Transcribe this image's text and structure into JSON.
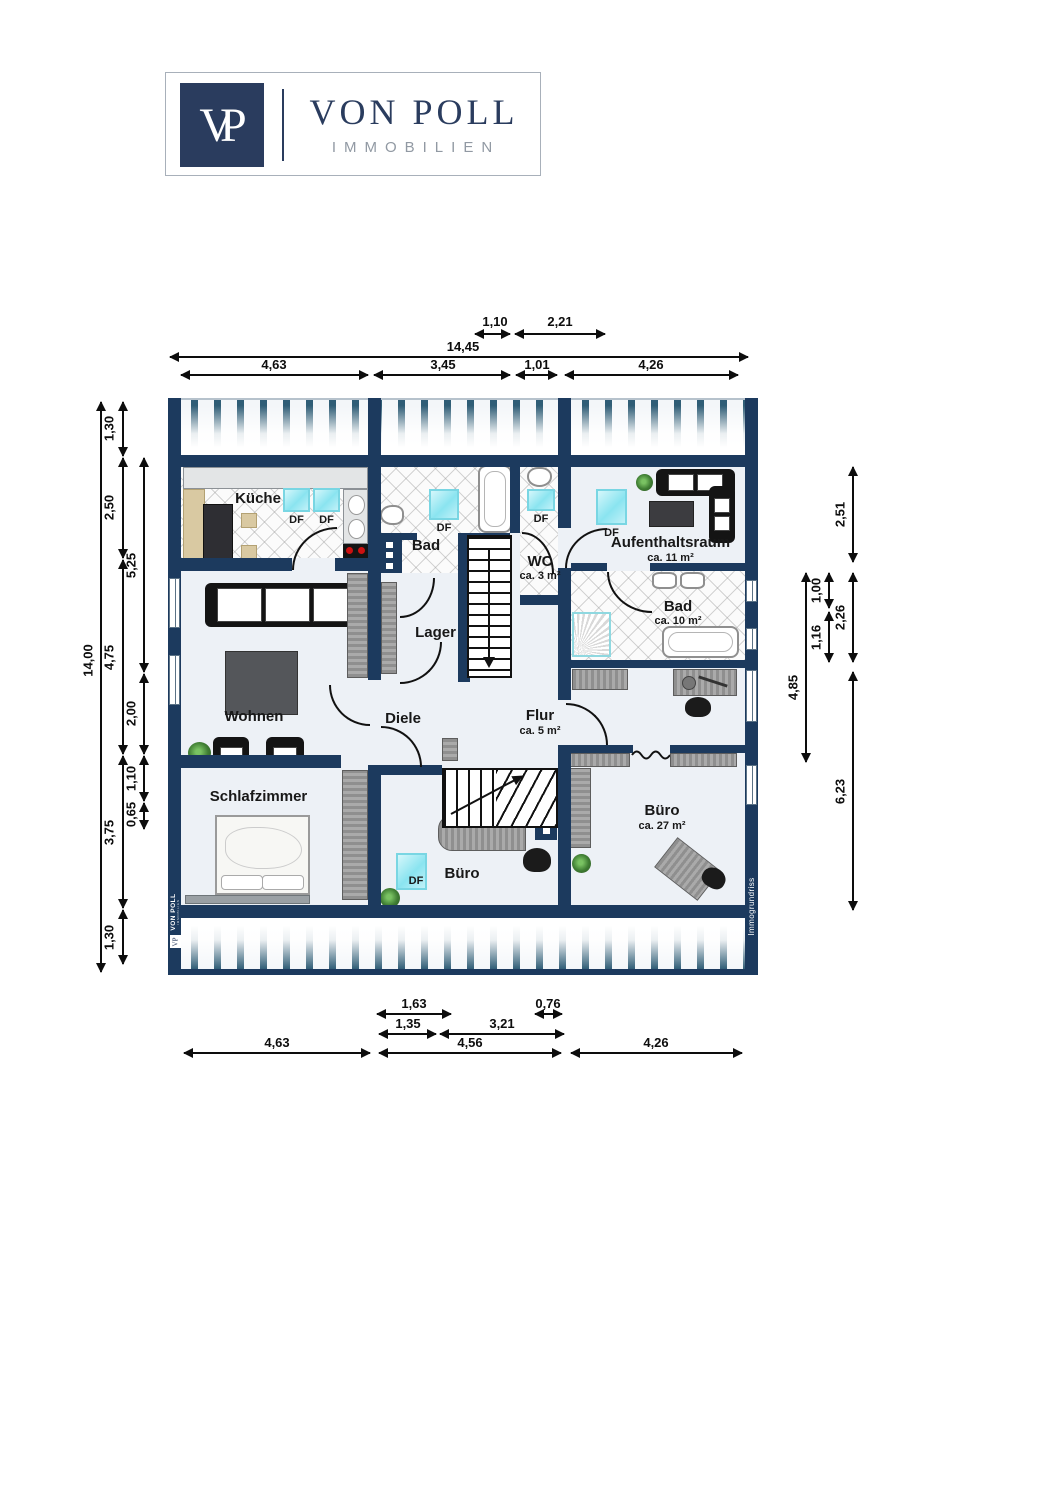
{
  "logo": {
    "monogram": "VP",
    "name": "VON POLL",
    "subtitle": "IMMOBILIEN"
  },
  "labels": {
    "df": "DF"
  },
  "rooms": {
    "kueche": {
      "label": "Küche"
    },
    "bad_top": {
      "label": "Bad"
    },
    "wc": {
      "label": "WC",
      "area": "ca. 3 m²"
    },
    "aufenthaltsraum": {
      "label": "Aufenthaltsraum",
      "area": "ca. 11 m²"
    },
    "bad_rechts": {
      "label": "Bad",
      "area": "ca. 10 m²"
    },
    "lager": {
      "label": "Lager"
    },
    "wohnen": {
      "label": "Wohnen"
    },
    "diele": {
      "label": "Diele"
    },
    "flur": {
      "label": "Flur",
      "area": "ca. 5 m²"
    },
    "schlafzimmer": {
      "label": "Schlafzimmer"
    },
    "buero_mitte": {
      "label": "Büro"
    },
    "buero_rechts": {
      "label": "Büro",
      "area": "ca. 27 m²"
    }
  },
  "dims": {
    "top": [
      "1,10",
      "2,21",
      "14,45",
      "4,63",
      "3,45",
      "1,01",
      "4,26"
    ],
    "bottom": [
      "1,63",
      "0,76",
      "1,35",
      "3,21",
      "4,63",
      "4,56",
      "4,26"
    ],
    "left": [
      "14,00",
      "1,30",
      "2,50",
      "4,75",
      "3,75",
      "1,30",
      "5,25",
      "2,00",
      "1,10",
      "0,65"
    ],
    "right": [
      "2,51",
      "1,00",
      "2,26",
      "1,16",
      "4,85",
      "6,23"
    ]
  },
  "watermarks": {
    "left_brand": "VON POLL",
    "left_brand_sub": "IMMOBILIEN",
    "left_logo": "VP",
    "right_credit": "Immogrundriss"
  },
  "colors": {
    "wall": "#1c3a5e",
    "roof_stripe": "#2f5d76",
    "skylight": "#8ae4f0",
    "floor": "#edf1f6",
    "burner_red": "#cc1111"
  }
}
